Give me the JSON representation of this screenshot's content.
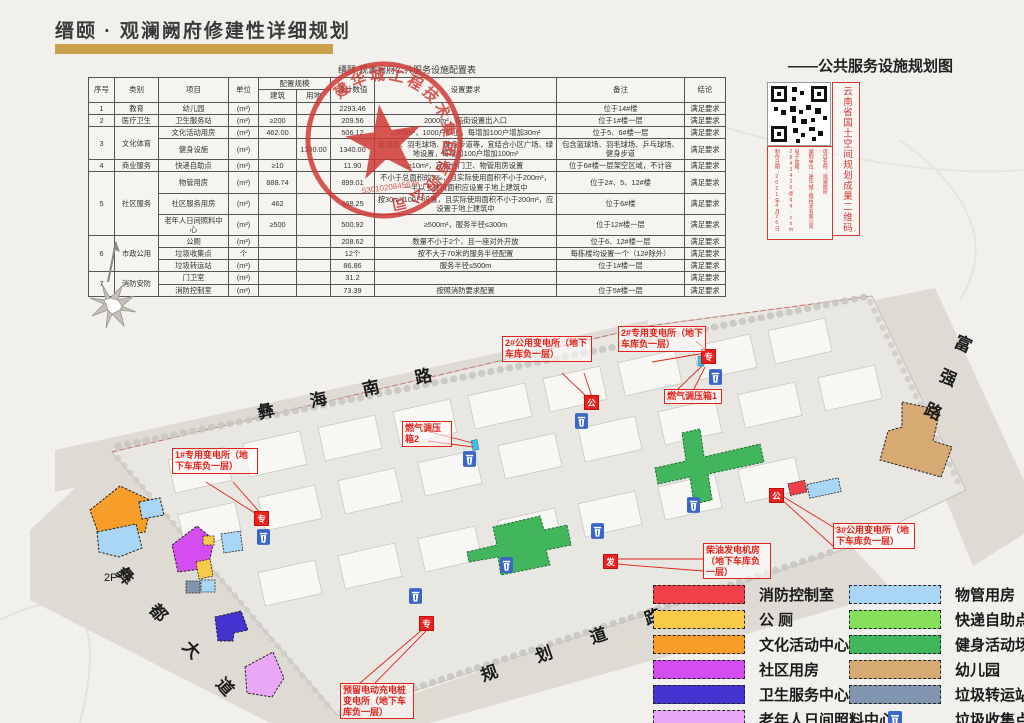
{
  "header": {
    "title": "缙颐 · 观澜阙府修建性详细规划",
    "map_title": "——公共服务设施规划图"
  },
  "stamp": {
    "company": "建华城工程技术集团有限公司",
    "number": "5301020845638"
  },
  "qr_panel": {
    "side_label": "云南省国土空间规划成果二维码",
    "columns": [
      "项目名称：观澜阙府",
      "编制单位：建华城工程技术有限公司",
      "电子信箱：2843426@qq.com",
      "制作日期：2021年4月26日"
    ]
  },
  "table": {
    "title": "缙颐·观澜阙府公共服务设施配置表",
    "header": [
      [
        {
          "t": "序号",
          "rs": 2,
          "h": 1
        },
        {
          "t": "类别",
          "rs": 2,
          "h": 1
        },
        {
          "t": "项目",
          "rs": 2,
          "h": 1
        },
        {
          "t": "单位",
          "rs": 2,
          "h": 1
        },
        {
          "t": "配置规模",
          "cs": 2,
          "h": 1
        },
        {
          "t": "设计数值",
          "rs": 2,
          "h": 1
        },
        {
          "t": "设置要求",
          "rs": 2,
          "h": 1
        },
        {
          "t": "备注",
          "rs": 2,
          "h": 1
        },
        {
          "t": "结论",
          "rs": 2,
          "h": 1
        }
      ],
      [
        {
          "t": "建筑",
          "h": 1
        },
        {
          "t": "用地",
          "h": 1
        }
      ]
    ],
    "rows": [
      [
        "1",
        "教育",
        "幼儿园",
        "(m²)",
        "",
        "",
        "2293.46",
        "",
        "位于14#楼",
        "满足要求"
      ],
      [
        "2",
        "医疗卫生",
        "卫生服务站",
        "(m²)",
        "≥200",
        "",
        "209.56",
        "2000m²，临街设置出入口",
        "位于1#楼一层",
        "满足要求"
      ],
      [
        {
          "t": "3",
          "rs": 2
        },
        {
          "t": "文化体育",
          "rs": 2
        },
        "文化活动用房",
        "(m²)",
        "462.00",
        "",
        "506.12",
        "≥300m²，1000户以上，每增加100户增加30m²",
        "位于5、6#楼一层",
        "满足要求"
      ],
      [
        "健身设施",
        "(m²)",
        "",
        "1340.00",
        "1340.00",
        "篮球场、羽毛球场、健身步道等，宜结合小区广场、绿地设置，每增加100户增加100m²",
        "包含篮球场、羽毛球场、乒乓球场、健身步道",
        "满足要求"
      ],
      [
        "4",
        "商业服务",
        "快递自助点",
        "(m²)",
        "≥10",
        "",
        "11.90",
        "≥10m²，宜结合门卫、物管用房设置",
        "位于6#楼一层架空区域，不计容",
        "满足要求"
      ],
      [
        {
          "t": "5",
          "rs": 3
        },
        {
          "t": "社区服务",
          "rs": 3
        },
        "物管用房",
        "(m²)",
        "888.74",
        "",
        "899.01",
        "不小于总面积的3‰，且实际使用面积不小于200m²，一半以上建筑面积应设置于地上建筑中",
        "位于2#、5、12#楼",
        "满足要求"
      ],
      [
        "社区服务用房",
        "(m²)",
        "462",
        "",
        "468.25",
        "按30m²/100户设置，且实际使用面积不小于200m²，应设置于地上建筑中",
        "位于6#楼",
        "满足要求"
      ],
      [
        "老年人日间照料中心",
        "(m²)",
        "≥500",
        "",
        "500.92",
        "≥500m²，服务半径≤300m",
        "位于12#楼一层",
        "满足要求"
      ],
      [
        {
          "t": "6",
          "rs": 3
        },
        {
          "t": "市政公用",
          "rs": 3
        },
        "公厕",
        "(m²)",
        "",
        "",
        "208.62",
        "数量不小于2个，且一座对外开放",
        "位于6、12#楼一层",
        "满足要求"
      ],
      [
        "垃圾收集点",
        "个",
        "",
        "",
        "12个",
        "按不大于70米的服务半径配置",
        "每栋楼均设置一个（12#除外）",
        "满足要求"
      ],
      [
        "垃圾转运站",
        "(m²)",
        "",
        "",
        "86.86",
        "服务半径≤500m",
        "位于1#楼一层",
        "满足要求"
      ],
      [
        {
          "t": "7",
          "rs": 2
        },
        {
          "t": "消防安防",
          "rs": 2
        },
        "门卫室",
        "(m²)",
        "",
        "",
        "31.2",
        "",
        "",
        "满足要求"
      ],
      [
        "消防控制室",
        "(m²)",
        "",
        "",
        "73.39",
        "按照消防要求配置",
        "位于5#楼一层",
        "满足要求"
      ]
    ]
  },
  "map": {
    "roads": [
      {
        "name": "彝 海 南 路"
      },
      {
        "name": "富强路"
      },
      {
        "name": "彝 都 大 道"
      },
      {
        "name": "规 划 道 路"
      }
    ],
    "floor_label": "2F",
    "annotations": [
      {
        "text": "2#专用变电所（地下车库负一层）",
        "x": 618,
        "y": 326,
        "w": 82
      },
      {
        "text": "2#公用变电所（地下车库负一层）",
        "x": 502,
        "y": 336,
        "w": 84
      },
      {
        "text": "燃气调压箱1",
        "x": 664,
        "y": 389,
        "w": 52
      },
      {
        "text": "燃气调压箱2",
        "x": 402,
        "y": 421,
        "w": 44
      },
      {
        "text": "1#专用变电所（地下车库负一层）",
        "x": 172,
        "y": 448,
        "w": 80
      },
      {
        "text": "3#公用变电所（地下车库负一层）",
        "x": 833,
        "y": 523,
        "w": 76
      },
      {
        "text": "柴油发电机房（地下车库负一层）",
        "x": 703,
        "y": 543,
        "w": 62
      },
      {
        "text": "预留电动充电桩变电所（地下车库负一层）",
        "x": 340,
        "y": 683,
        "w": 68
      }
    ],
    "markers": [
      {
        "char": "专",
        "x": 701,
        "y": 349
      },
      {
        "char": "公",
        "x": 584,
        "y": 395
      },
      {
        "char": "专",
        "x": 254,
        "y": 511
      },
      {
        "char": "公",
        "x": 769,
        "y": 488
      },
      {
        "char": "发",
        "x": 603,
        "y": 554
      },
      {
        "char": "专",
        "x": 419,
        "y": 616
      }
    ],
    "bins": [
      {
        "x": 709,
        "y": 369
      },
      {
        "x": 575,
        "y": 413
      },
      {
        "x": 463,
        "y": 451
      },
      {
        "x": 257,
        "y": 529
      },
      {
        "x": 687,
        "y": 497
      },
      {
        "x": 591,
        "y": 523
      },
      {
        "x": 500,
        "y": 557
      },
      {
        "x": 409,
        "y": 588
      }
    ]
  },
  "legend": {
    "left": [
      {
        "label": "消防控制室",
        "color": "#f0404a"
      },
      {
        "label": "公 厕",
        "color": "#f8ca48"
      },
      {
        "label": "文化活动中心",
        "color": "#f79d2a"
      },
      {
        "label": "社区用房",
        "color": "#d44df0"
      },
      {
        "label": "卫生服务中心",
        "color": "#4433cf"
      },
      {
        "label": "老年人日间照料中心",
        "color": "#eaa7f6"
      }
    ],
    "right": [
      {
        "label": "物管用房",
        "color": "#a8d6f4"
      },
      {
        "label": "快递自助点",
        "color": "#86e05c"
      },
      {
        "label": "健身活动场地",
        "color": "#41b65c"
      },
      {
        "label": "幼儿园",
        "color": "#d7aa73"
      },
      {
        "label": "垃圾转运站",
        "color": "#8295af"
      },
      {
        "label": "垃圾收集点",
        "icon": "trash-bin-icon",
        "color": "#3a66c8"
      }
    ]
  }
}
